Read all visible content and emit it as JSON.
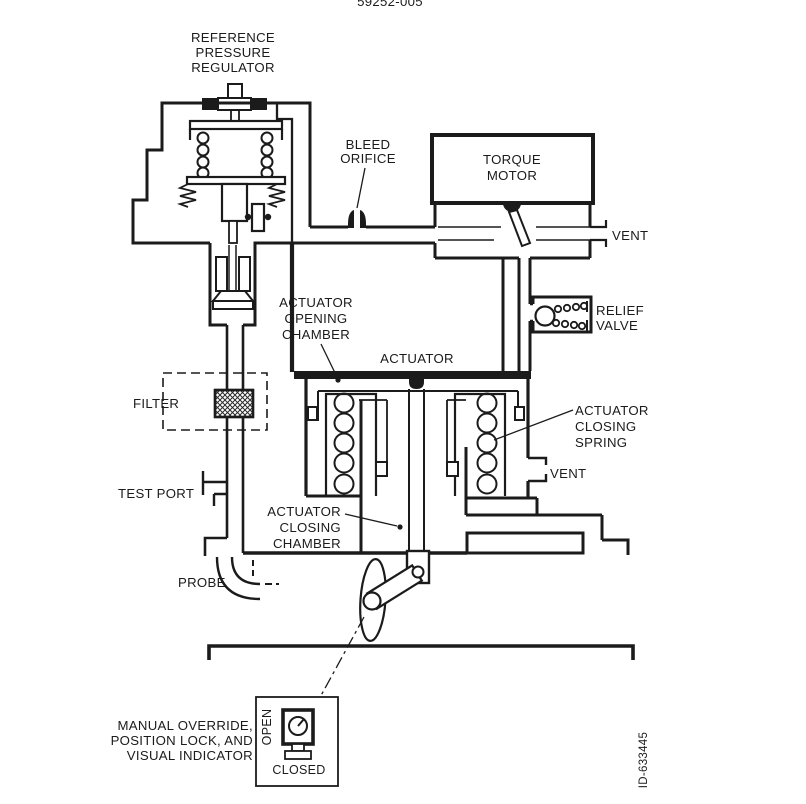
{
  "figure": {
    "doc_number_clipped": "59252-005",
    "figure_id": "ID-633445",
    "line_color": "#1b1b1b",
    "labels": {
      "regulator": [
        "REFERENCE",
        "PRESSURE",
        "REGULATOR"
      ],
      "bleed_orifice": [
        "BLEED",
        "ORIFICE"
      ],
      "torque_motor": [
        "TORQUE",
        "MOTOR"
      ],
      "vent_torque_motor": "VENT",
      "relief_valve": [
        "RELIEF",
        "VALVE"
      ],
      "opening_chamber": [
        "ACTUATOR",
        "OPENING",
        "CHAMBER"
      ],
      "actuator": "ACTUATOR",
      "closing_spring": [
        "ACTUATOR",
        "CLOSING",
        "SPRING"
      ],
      "vent_actuator": "VENT",
      "filter": "FILTER",
      "test_port": "TEST PORT",
      "closing_chamber": [
        "ACTUATOR",
        "CLOSING",
        "CHAMBER"
      ],
      "probe": "PROBE",
      "manual_override": [
        "MANUAL OVERRIDE,",
        "POSITION LOCK, AND",
        "VISUAL INDICATOR"
      ],
      "indicator_open": "OPEN",
      "indicator_closed": "CLOSED"
    }
  }
}
